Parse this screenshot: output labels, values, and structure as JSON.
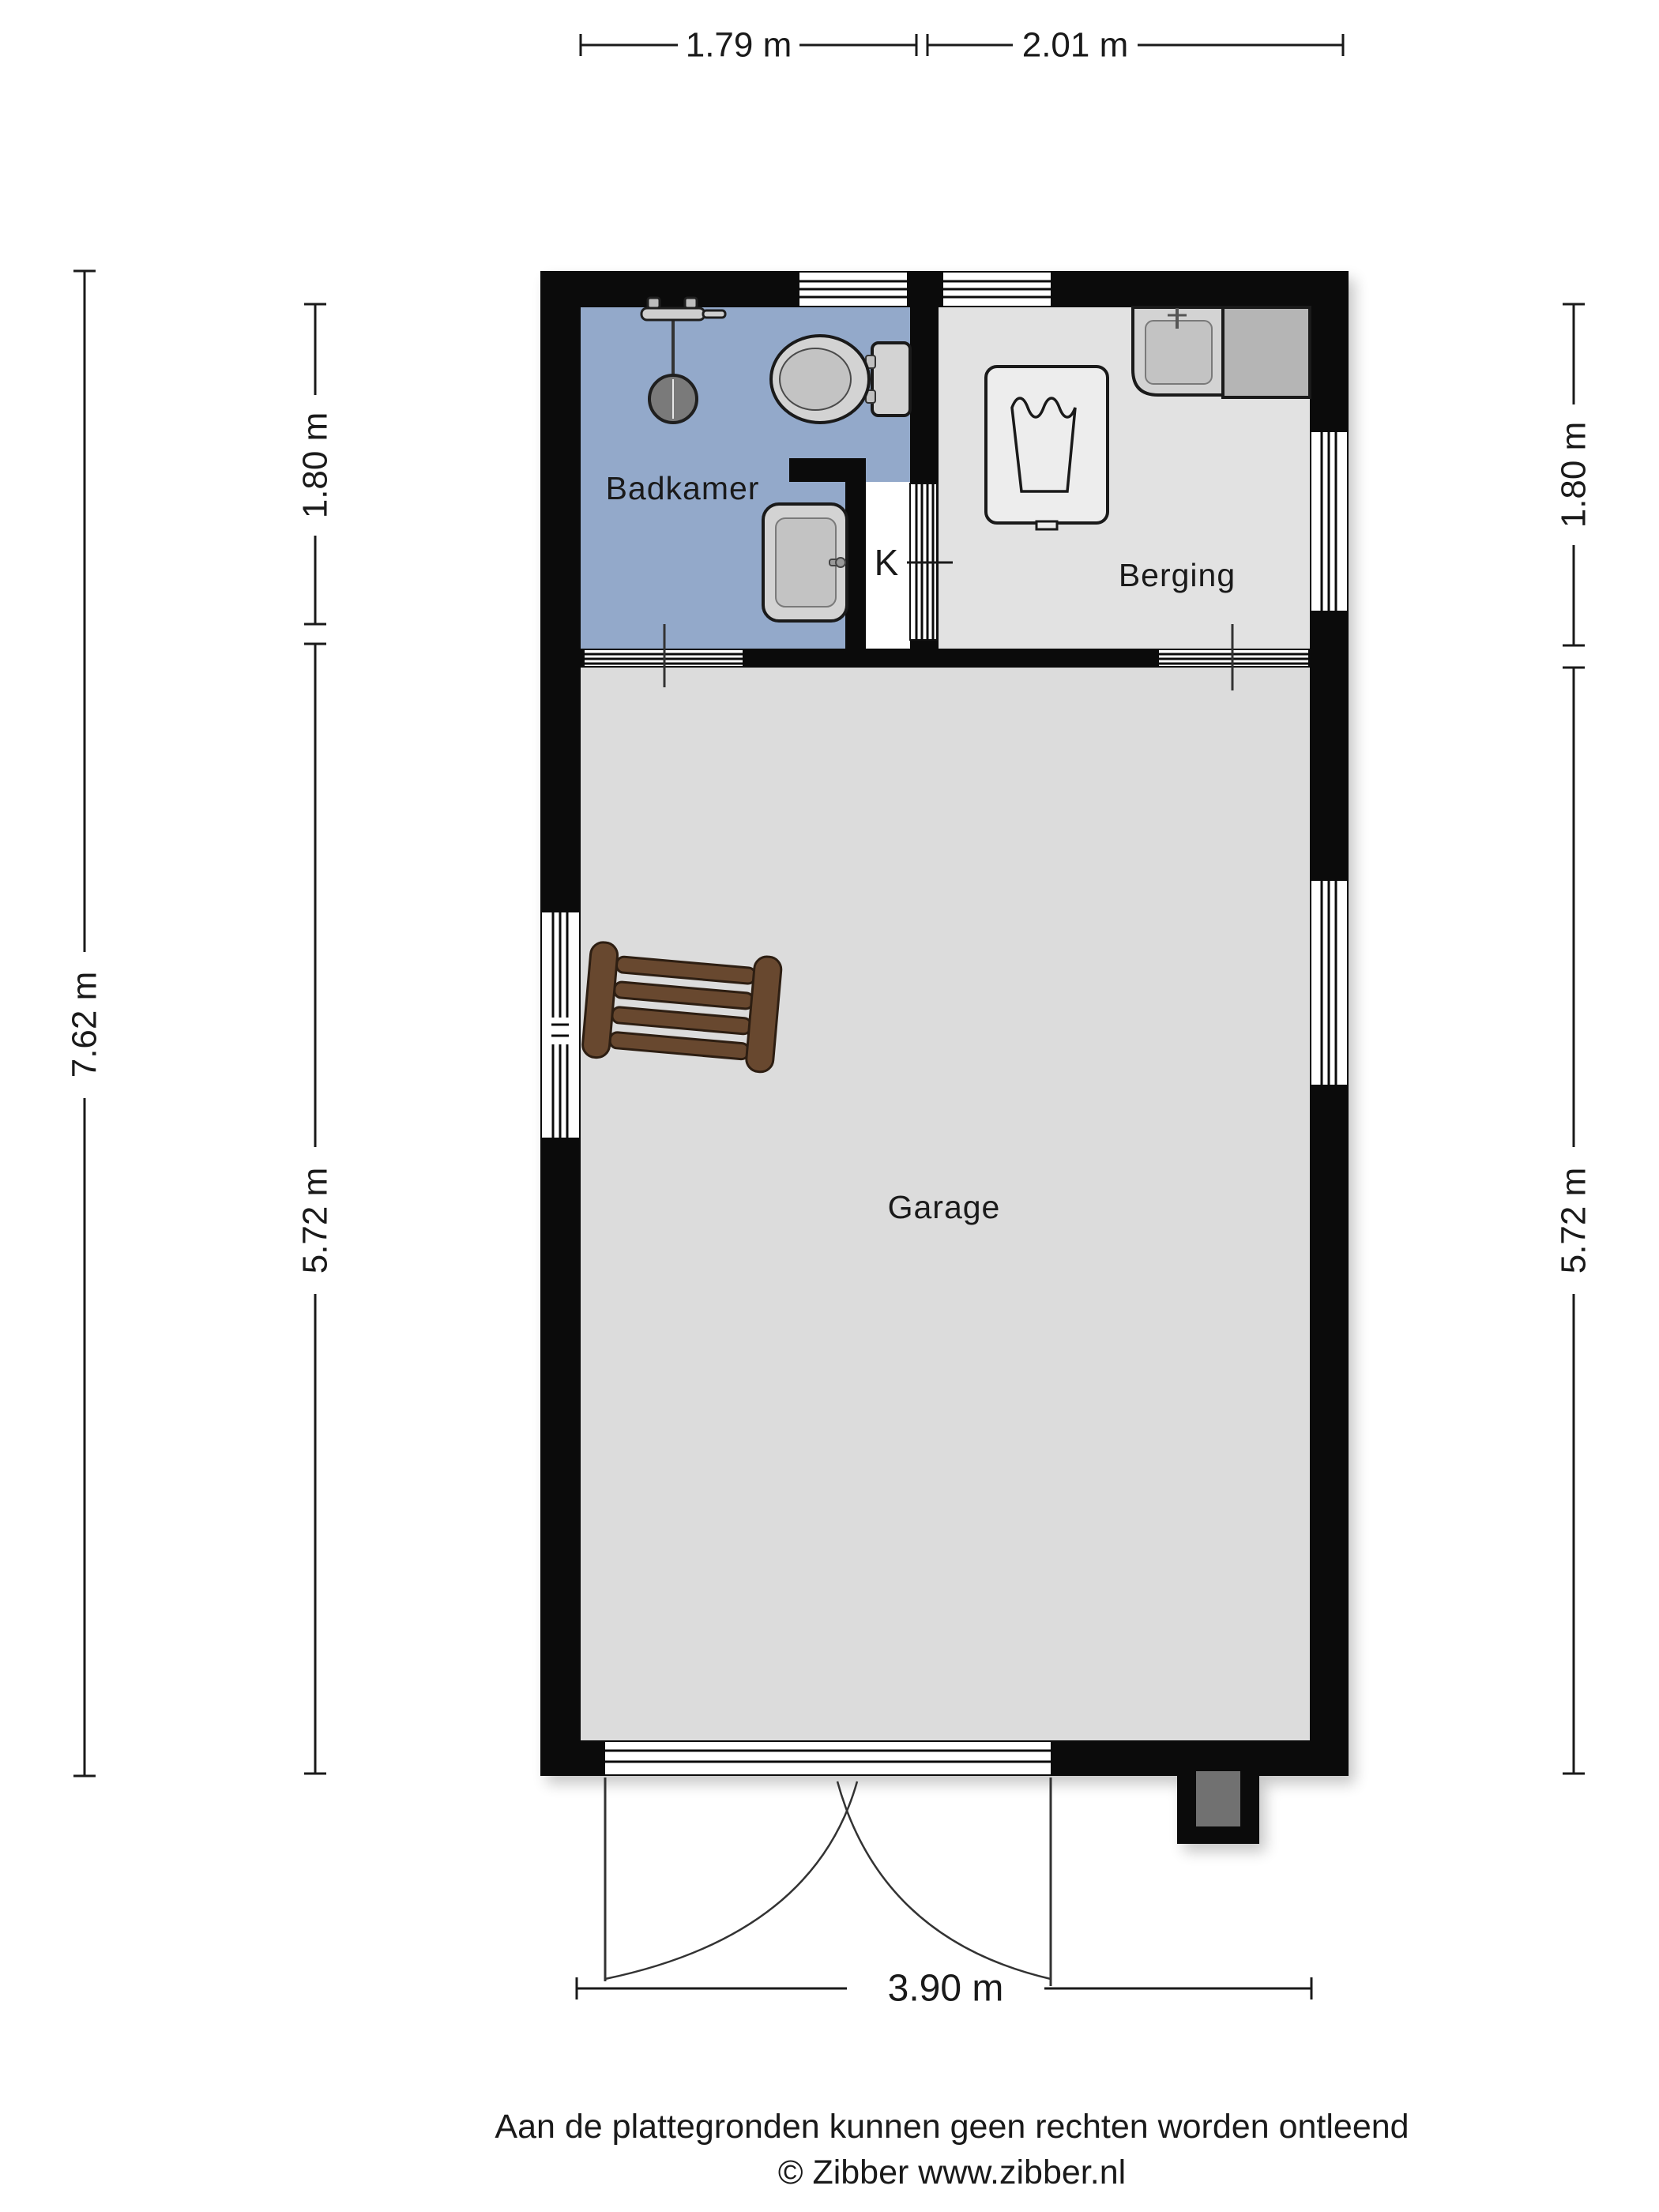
{
  "rooms": {
    "badkamer": {
      "label": "Badkamer"
    },
    "berging": {
      "label": "Berging"
    },
    "garage": {
      "label": "Garage"
    },
    "closet": {
      "label": "K"
    }
  },
  "dimensions": {
    "top": [
      {
        "label": "1.79 m"
      },
      {
        "label": "2.01 m"
      }
    ],
    "bottom": [
      {
        "label": "3.90 m"
      }
    ],
    "left_outer": [
      {
        "label": "7.62 m"
      }
    ],
    "left_inner": [
      {
        "label": "1.80 m"
      },
      {
        "label": "5.72 m"
      }
    ],
    "right": [
      {
        "label": "1.80 m"
      },
      {
        "label": "5.72 m"
      }
    ]
  },
  "footer": {
    "disclaimer": "Aan de plattegronden kunnen geen rechten worden ontleend",
    "credit": "© Zibber www.zibber.nl"
  },
  "icons": {
    "shower": "shower-icon",
    "toilet": "toilet-icon",
    "bathroom_sink": "sink-icon",
    "utility_sink": "sink-icon",
    "washing_machine": "washing-machine-icon",
    "ladder": "ladder-icon"
  },
  "colors": {
    "wall": "#0b0b0b",
    "text": "#1a1a1a",
    "outline": "#1f1f1f",
    "bath_floor": "#93a9ca",
    "berging_floor": "#e2e2e2",
    "garage_floor": "#dcdcdc",
    "fixture_light": "#d3d3d3",
    "fixture_mid": "#c3c3c3",
    "counter": "#b5b5b5",
    "washer": "#ededed",
    "shower_head": "#7a7a7a",
    "wood": "#68482f",
    "wood_dark": "#2d1e12",
    "inset_gray": "#717171"
  }
}
